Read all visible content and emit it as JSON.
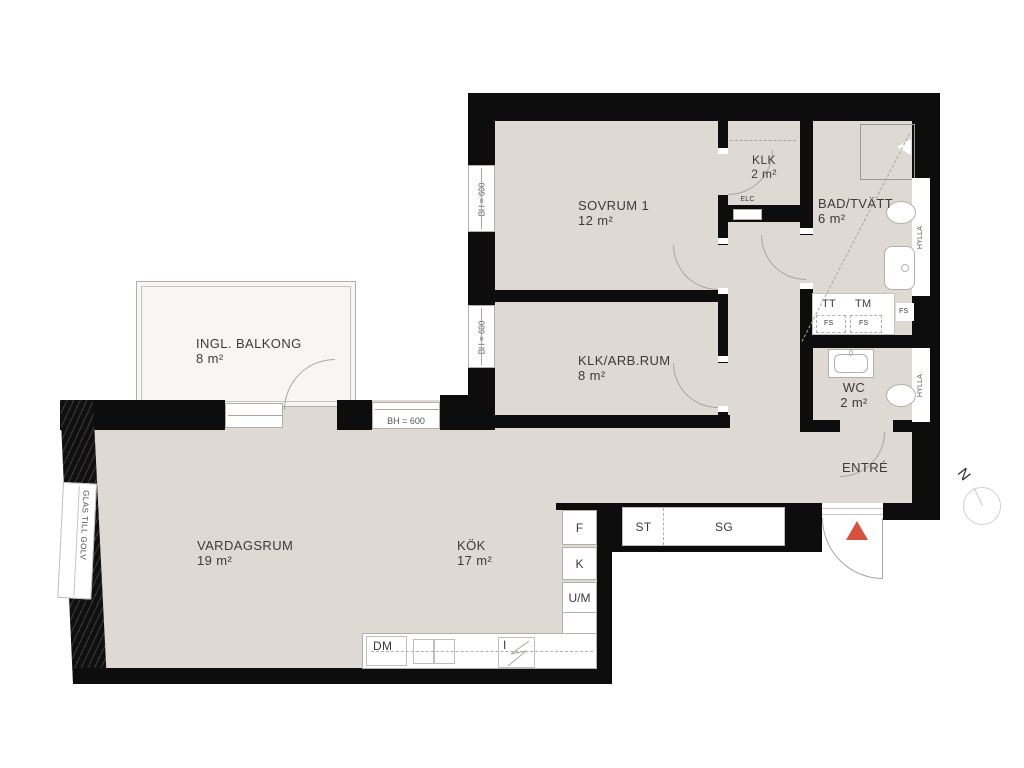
{
  "plan": {
    "title": "apartment-floor-plan",
    "rooms": {
      "sovrum1": {
        "name": "SOVRUM 1",
        "area": "12 m²"
      },
      "klk": {
        "name": "KLK",
        "area": "2 m²"
      },
      "bad_tvatt": {
        "name": "BAD/TVÄTT",
        "area": "6 m²"
      },
      "wc": {
        "name": "WC",
        "area": "2 m²"
      },
      "klk_arbrum": {
        "name": "KLK/ARB.RUM",
        "area": "8 m²"
      },
      "ingl_balkong": {
        "name": "INGL. BALKONG",
        "area": "8 m²"
      },
      "vardagsrum": {
        "name": "VARDAGSRUM",
        "area": "19 m²"
      },
      "kok": {
        "name": "KÖK",
        "area": "17 m²"
      },
      "entre": {
        "name": "ENTRÉ"
      }
    },
    "fixtures": {
      "elc": "ELC",
      "tt": "TT",
      "tm": "TM",
      "fs": "FS",
      "hylla": "HYLLA",
      "f": "F",
      "k": "K",
      "um": "U/M",
      "dm": "DM",
      "hob": "I",
      "st": "ST",
      "sg": "SG"
    },
    "windows": {
      "bh600": "BH = 600",
      "glas_till_golv": "GLAS TILL GOLV"
    },
    "compass": {
      "north": "N"
    },
    "colors": {
      "wall": "#0d0d0d",
      "floor": "#ded9d3",
      "balcony_floor": "#f7f6f4",
      "entry_marker": "#d8503f",
      "line": "#a9a6a2",
      "text": "#3b3b3b"
    }
  }
}
